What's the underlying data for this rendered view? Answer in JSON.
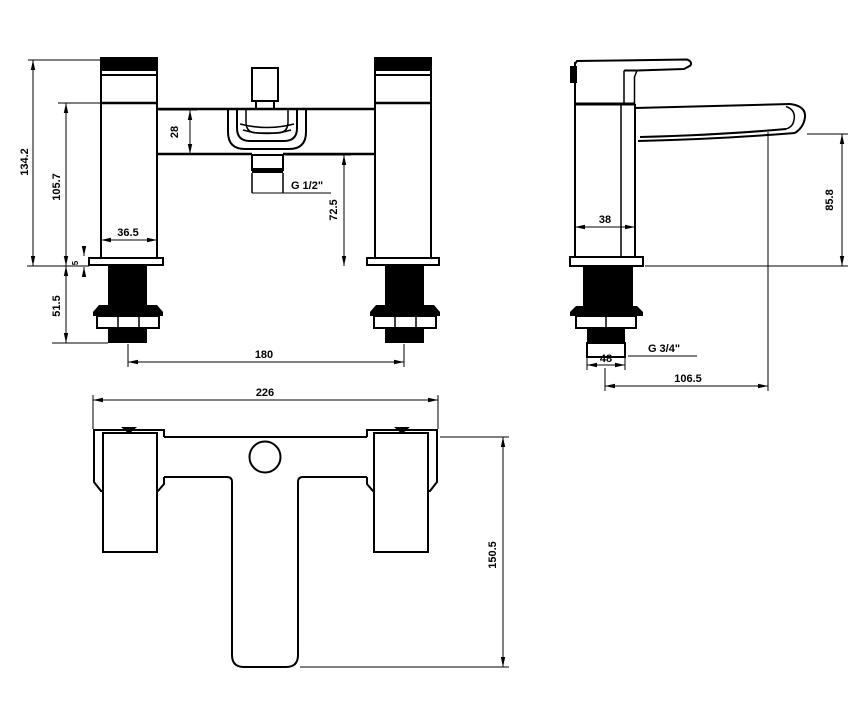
{
  "title": "Bath shower mixer tap technical dimension drawing",
  "colors": {
    "line": "#000000",
    "background": "#ffffff"
  },
  "dims": {
    "front": {
      "h_total": "134.2",
      "h_body": "105.7",
      "bar": "28",
      "w_body": "36.5",
      "shower_thread": "G 1/2\"",
      "h_clear": "72.5",
      "plate": "5",
      "tail": "51.5",
      "centres": "180"
    },
    "side": {
      "depth": "38",
      "spout_h": "85.8",
      "inlet_thread": "G 3/4\"",
      "tail_w": "48",
      "reach": "106.5"
    },
    "plan": {
      "width": "226",
      "depth": "150.5"
    }
  }
}
